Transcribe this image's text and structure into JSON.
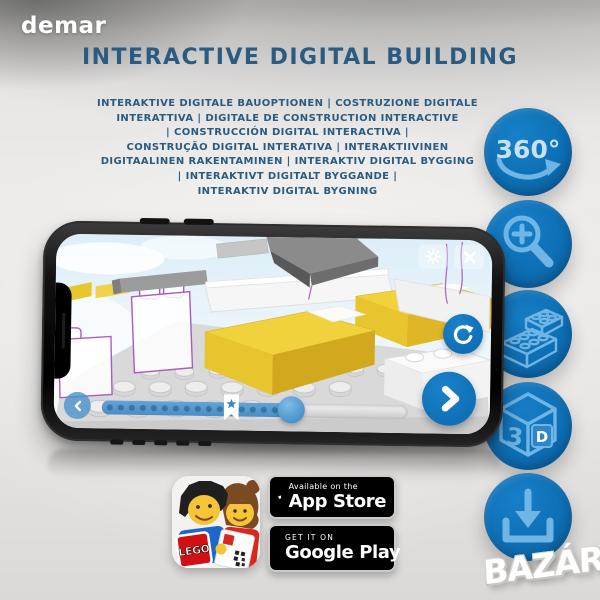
{
  "colors": {
    "accent_blue": "#0E6FB4",
    "glyph_light_blue": "#6FB5E5",
    "heading_blue": "#2A5B81",
    "lego_yellow": "#F2D23C",
    "ghost_outline_purple": "#A85CC2",
    "badge_black": "#000000"
  },
  "brand": {
    "logo_text": "demar"
  },
  "header": {
    "title": "INTERACTIVE DIGITAL BUILDING",
    "subtitle_lines": [
      "INTERAKTIVE DIGITALE BAUOPTIONEN | COSTRUZIONE DIGITALE",
      "INTERATTIVA | DIGITALE DE CONSTRUCTION INTERACTIVE",
      "| CONSTRUCCIÓN DIGITAL INTERACTIVA |",
      "CONSTRUÇÃO DIGITAL INTERATIVA | INTERAKTIIVINEN",
      "DIGITAALINEN RAKENTAMINEN | INTERAKTIV DIGITAL BYGGING",
      "| INTERAKTIVT DIGITALT BYGGANDE |",
      "INTERAKTIV DIGITAL BYGNING"
    ]
  },
  "feature_icons": [
    {
      "name": "rotate-360-icon",
      "label": "360°"
    },
    {
      "name": "zoom-in-icon"
    },
    {
      "name": "lego-brick-icon"
    },
    {
      "name": "view-3d-icon",
      "label_left": "3",
      "label_right": "D"
    },
    {
      "name": "download-icon"
    }
  ],
  "phone_app": {
    "toolbar_icons": [
      "settings-gear",
      "close"
    ],
    "controls": [
      "rotate-reset",
      "previous-step",
      "next-step"
    ],
    "slider": {
      "progress_percent": 62,
      "bookmark_at_percent": 40,
      "dot_steps": 16
    }
  },
  "store_badges": {
    "app_store": {
      "line1": "Available on the",
      "line2": "App Store"
    },
    "google_play": {
      "line1": "GET IT ON",
      "line2": "Google Play"
    },
    "lego_app": {
      "brand": "LEGO"
    }
  },
  "watermark": {
    "text": "BAZÁR"
  }
}
